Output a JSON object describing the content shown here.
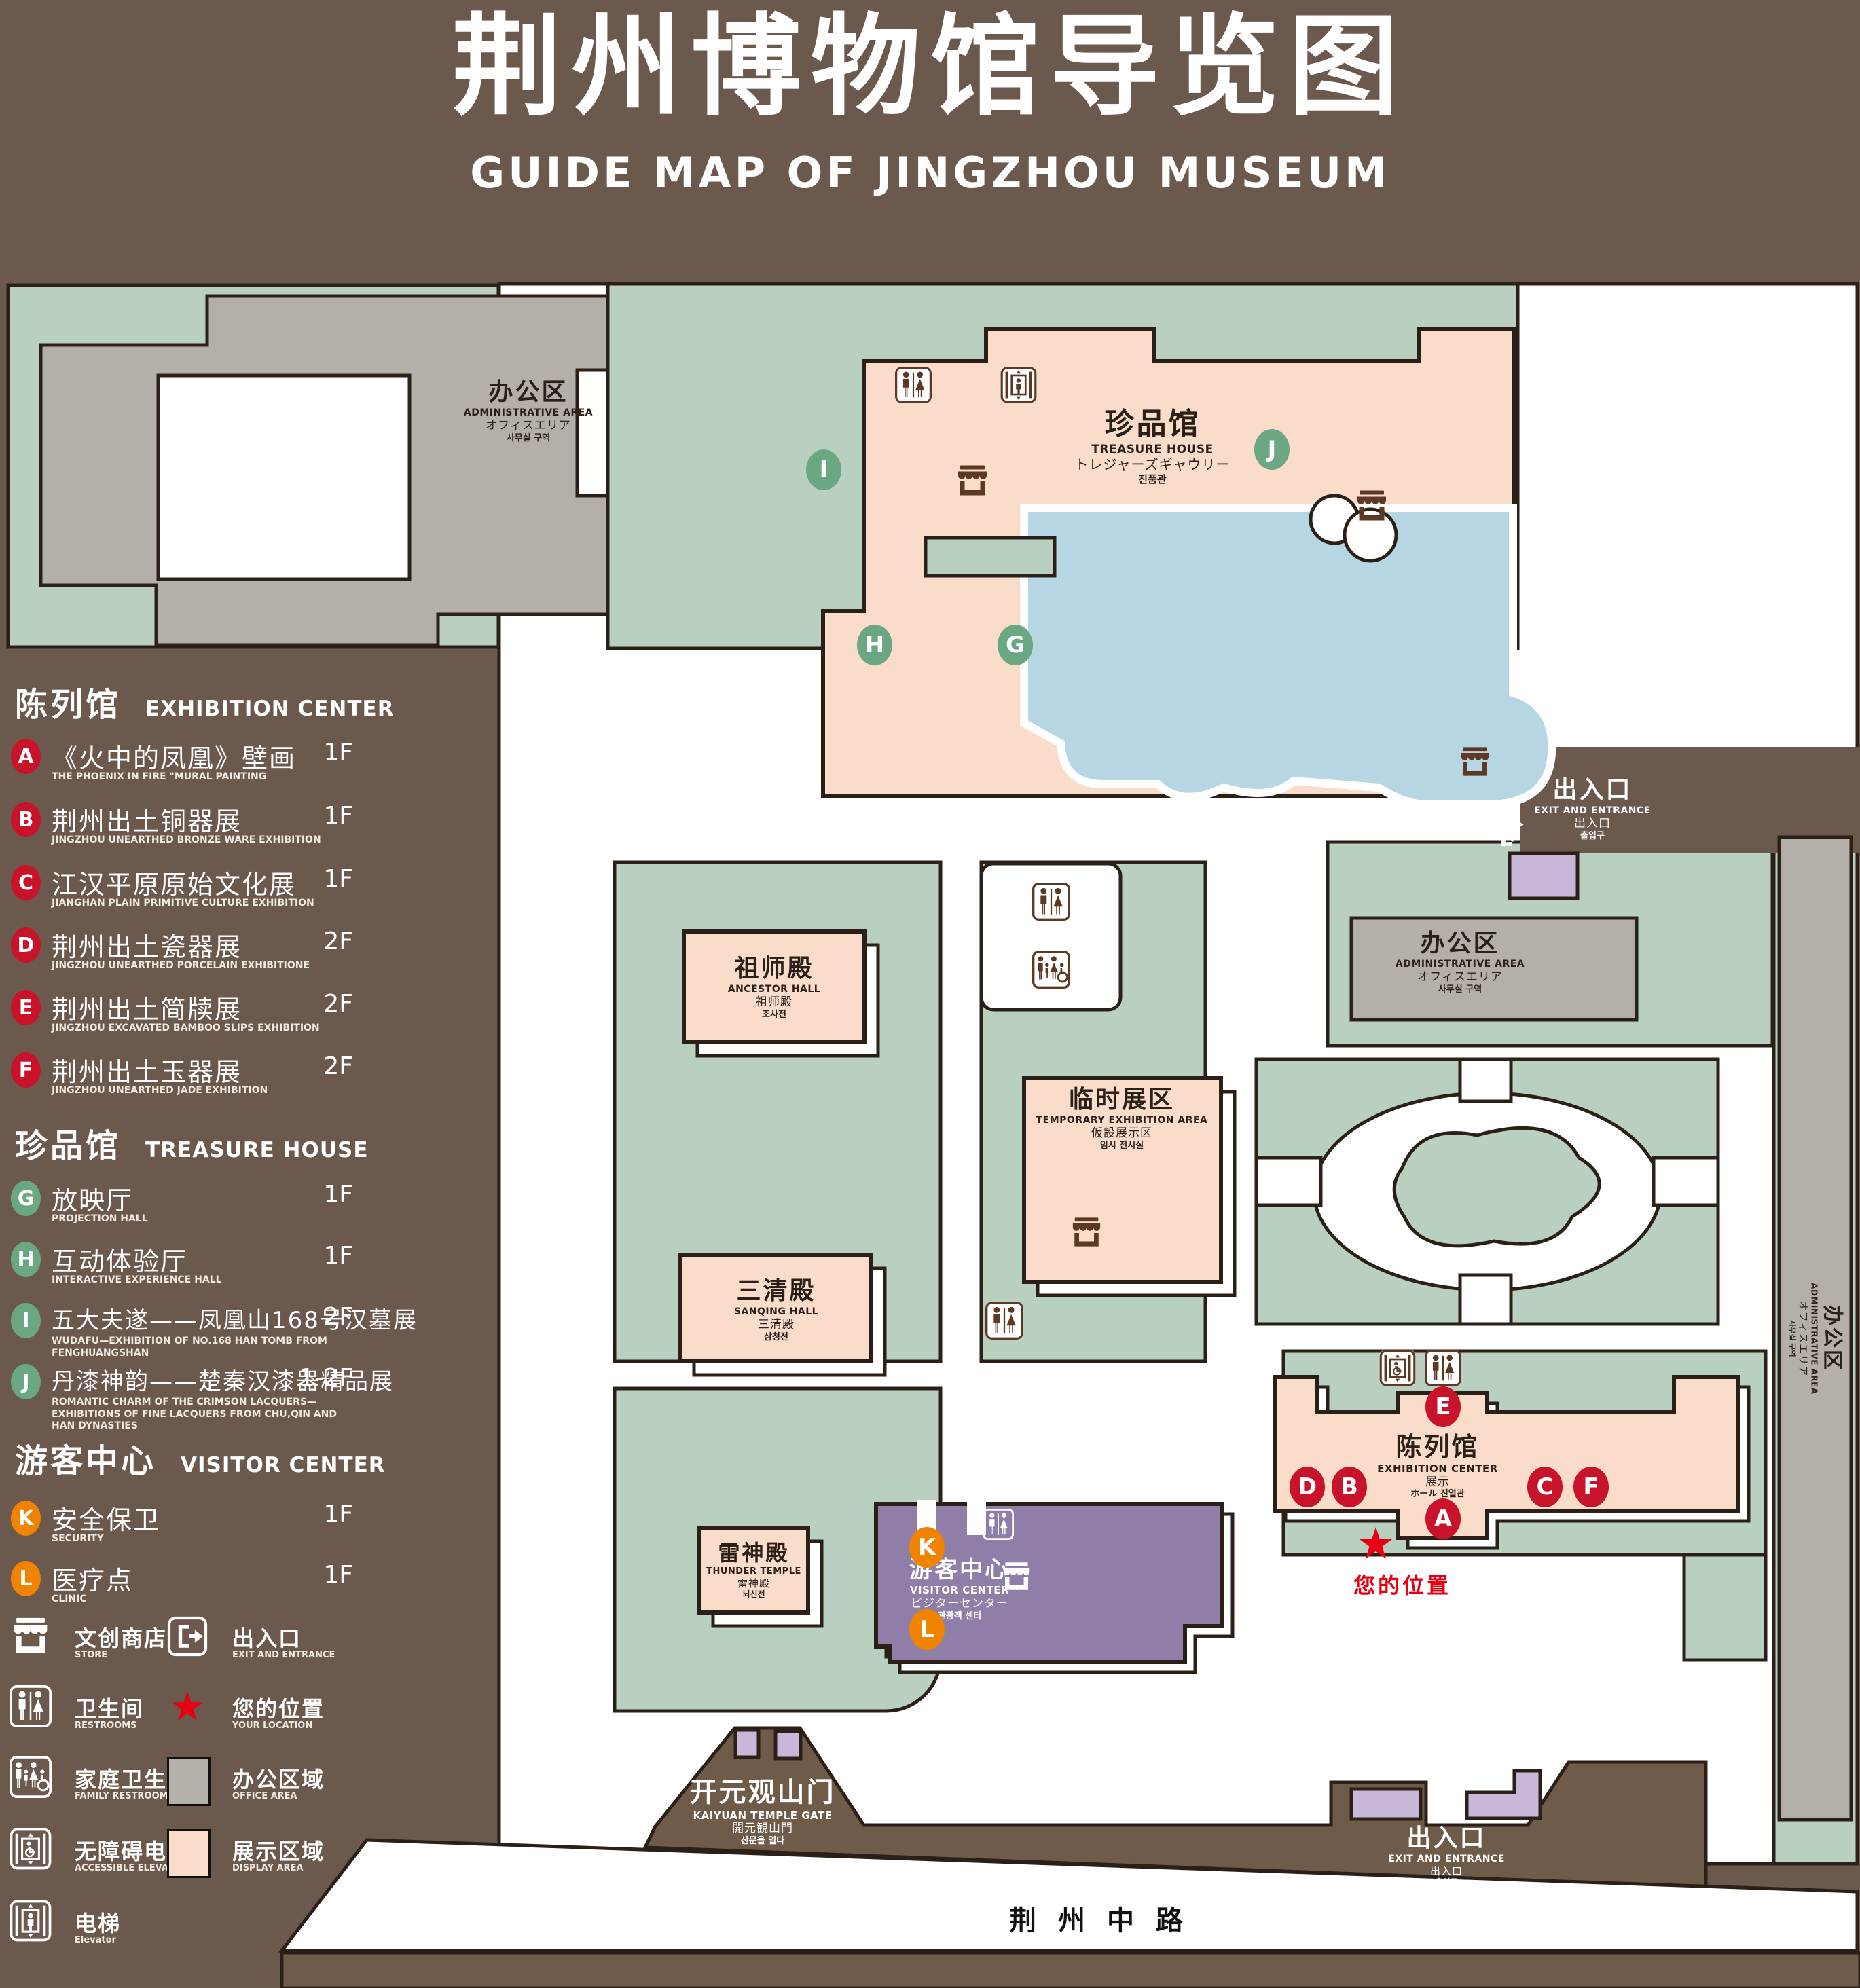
{
  "title": {
    "zh": "荆州博物馆导览图",
    "en": "GUIDE MAP OF JINGZHOU MUSEUM"
  },
  "legend": {
    "sections": [
      {
        "zh": "陈列馆",
        "en": "EXHIBITION CENTER",
        "items": [
          {
            "letter": "A",
            "zh": "《火中的凤凰》壁画",
            "en": "THE PHOENIX IN FIRE \"MURAL PAINTING",
            "floor": "1F"
          },
          {
            "letter": "B",
            "zh": "荆州出土铜器展",
            "en": "JINGZHOU UNEARTHED BRONZE WARE EXHIBITION",
            "floor": "1F"
          },
          {
            "letter": "C",
            "zh": "江汉平原原始文化展",
            "en": "JIANGHAN PLAIN PRIMITIVE CULTURE EXHIBITION",
            "floor": "1F"
          },
          {
            "letter": "D",
            "zh": "荆州出土瓷器展",
            "en": "JINGZHOU UNEARTHED PORCELAIN EXHIBITIONE",
            "floor": "2F"
          },
          {
            "letter": "E",
            "zh": "荆州出土简牍展",
            "en": "JINGZHOU EXCAVATED BAMBOO SLIPS EXHIBITION",
            "floor": "2F"
          },
          {
            "letter": "F",
            "zh": "荆州出土玉器展",
            "en": "JINGZHOU UNEARTHED JADE EXHIBITION",
            "floor": "2F"
          }
        ]
      },
      {
        "zh": "珍品馆",
        "en": "TREASURE HOUSE",
        "items": [
          {
            "letter": "G",
            "zh": "放映厅",
            "en": "PROJECTION HALL",
            "floor": "1F"
          },
          {
            "letter": "H",
            "zh": "互动体验厅",
            "en": "INTERACTIVE EXPERIENCE HALL",
            "floor": "1F"
          },
          {
            "letter": "I",
            "zh": "五大夫遂——凤凰山168号汉墓展",
            "en": "WUDAFU—EXHIBITION OF NO.168 HAN TOMB FROM FENGHUANGSHAN",
            "floor": "2F"
          },
          {
            "letter": "J",
            "zh": "丹漆神韵——楚秦汉漆器精品展",
            "en": "ROMANTIC CHARM OF THE CRIMSON LACQUERS—EXHIBITIONS OF FINE LACQUERS FROM CHU,QIN AND HAN DYNASTIES",
            "floor": "1-2F"
          }
        ]
      },
      {
        "zh": "游客中心",
        "en": "VISITOR CENTER",
        "items": [
          {
            "letter": "K",
            "zh": "安全保卫",
            "en": "SECURITY",
            "floor": "1F"
          },
          {
            "letter": "L",
            "zh": "医疗点",
            "en": "CLINIC",
            "floor": "1F"
          }
        ]
      }
    ],
    "facilities": [
      {
        "icon": "store-icon",
        "zh": "文创商店",
        "en": "STORE"
      },
      {
        "icon": "exit-icon",
        "zh": "出入口",
        "en": "EXIT AND ENTRANCE"
      },
      {
        "icon": "restrooms-icon",
        "zh": "卫生间",
        "en": "RESTROOMS"
      },
      {
        "icon": "your-location-icon",
        "zh": "您的位置",
        "en": "YOUR LOCATION"
      },
      {
        "icon": "family-restrooms-icon",
        "zh": "家庭卫生间",
        "en": "FAMILY RESTROOMS"
      },
      {
        "icon": "office-area-swatch",
        "zh": "办公区域",
        "en": "OFFICE AREA"
      },
      {
        "icon": "accessible-elevator-icon",
        "zh": "无障碍电梯",
        "en": "ACCESSIBLE ELEVATOR"
      },
      {
        "icon": "display-area-swatch",
        "zh": "展示区域",
        "en": "DISPLAY AREA"
      },
      {
        "icon": "elevator-icon",
        "zh": "电梯",
        "en": "Elevator"
      }
    ]
  },
  "map": {
    "buildings": {
      "admin_tl": {
        "zh": "办公区",
        "en": "ADMINISTRATIVE AREA",
        "ja": "オフィスエリア",
        "ko": "사무실 구역"
      },
      "treasure": {
        "zh": "珍品馆",
        "en": "TREASURE HOUSE",
        "ja": "トレジャーズギャウリー",
        "ko": "진품관"
      },
      "ancestor": {
        "zh": "祖师殿",
        "en": "ANCESTOR HALL",
        "ja": "祖师殿",
        "ko": "조사전"
      },
      "temporary": {
        "zh": "临时展区",
        "en": "TEMPORARY EXHIBITION AREA",
        "ja": "仮設展示区",
        "ko": "임시 전시실"
      },
      "admin_right": {
        "zh": "办公区",
        "en": "ADMINISTRATIVE AREA",
        "ja": "オフィスエリア",
        "ko": "사무실 구역"
      },
      "admin_tower": {
        "zh": "办公区",
        "en": "ADMINISTRATIVE AREA",
        "ja": "オフィスエリア",
        "ko": "사무실 구역"
      },
      "sanqing": {
        "zh": "三清殿",
        "en": "SANQING HALL",
        "ja": "三清殿",
        "ko": "삼청전"
      },
      "thunder": {
        "zh": "雷神殿",
        "en": "THUNDER TEMPLE",
        "ja": "雷神殿",
        "ko": "뇌신전"
      },
      "visitor": {
        "zh": "游客中心",
        "en": "VISITOR CENTER",
        "ja": "ビジターセンター",
        "ko": "관광객 센터"
      },
      "exhibition": {
        "zh": "陈列馆",
        "en": "EXHIBITION CENTER",
        "ja": "展示",
        "ko": "ホール 진열관"
      }
    },
    "exits": {
      "east": {
        "zh": "出入口",
        "en": "EXIT AND ENTRANCE",
        "ja": "出入口",
        "ko": "출입구"
      },
      "south": {
        "zh": "出入口",
        "en": "EXIT AND ENTRANCE",
        "ja": "出入口",
        "ko": "출입구"
      }
    },
    "gate": {
      "zh": "开元观山门",
      "en": "KAIYUAN TEMPLE GATE",
      "ja": "開元観山門",
      "ko": "산문을 열다"
    },
    "road": {
      "name": "荆州中路"
    },
    "your_location": {
      "zh": "您的位置"
    },
    "markers": {
      "A": "A",
      "B": "B",
      "C": "C",
      "D": "D",
      "E": "E",
      "F": "F",
      "G": "G",
      "H": "H",
      "I": "I",
      "J": "J",
      "K": "K",
      "L": "L"
    }
  },
  "colors": {
    "bg": "#6a594c",
    "ground": "#6f5b49",
    "green": "#b9d0c1",
    "pink": "#f9dcca",
    "gray": "#b4afa9",
    "blue": "#b7d6e3",
    "purple": "#8f7fa8",
    "lavender": "#c8b7d8",
    "marker_red": "#c9132b",
    "marker_green": "#6ba783",
    "marker_orange": "#f08300",
    "location_red": "#e60012",
    "icon_brown": "#5c3825",
    "ink": "#2b2018"
  }
}
